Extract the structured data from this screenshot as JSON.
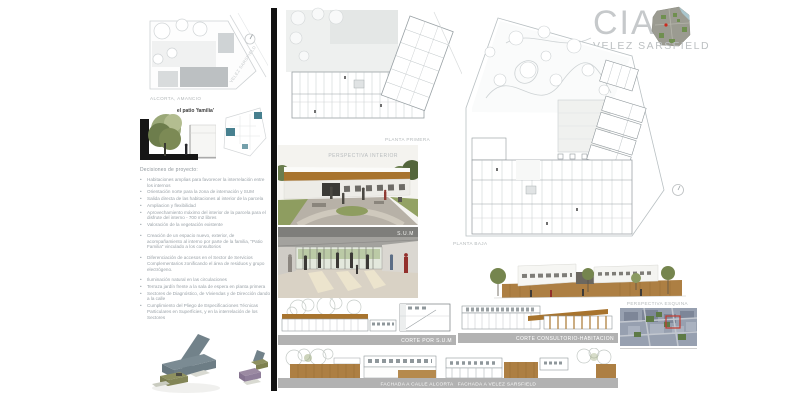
{
  "header": {
    "title": "CIA",
    "subtitle": "VELEZ SARSFIELD"
  },
  "site_plan": {
    "street_bottom": "ALCORTA, AMANCIO",
    "street_side": "VELEZ SARSFIELD"
  },
  "patio_section": {
    "caption": "el patio 'familia'"
  },
  "decisions": {
    "heading": "Decisiones de proyecto:",
    "group1": [
      "Habitaciones amplias para favorecer la interrelación entre los internos",
      "Orientación norte para la zona de internación y SUM",
      "Salida directa de las habitaciones al interior de la parcela",
      "Ampliacion y flexibilidad",
      "Aprovechamiento máximo del interior de la parcela para el disfrute del interno - 700 m2 libres",
      "Valoración de la vegetación existente"
    ],
    "group2": [
      "Creación de un espacio nuevo, exterior, de acompañamiento al interno por parte de la familia, \"Patio Familia\" vinculado a los consultorios"
    ],
    "group3": [
      "Diferenciación de accesos en el Sector de Servicios Complementarios zonificando el área de residuos y grupo electrógeno."
    ],
    "group4": [
      "Iluminación natural en las circulaciones",
      "Terraza jardín frente a la sala de espera en planta primera",
      "Sectores de Diagnóstico, de Viviendas y de Dirección dando a la calle",
      "Cumplimiento del Pliego de Especificaciones Técnicas Particulares en Superficies, y en la interrelación de los Sectores"
    ]
  },
  "drawings": {
    "planta_primera": "PLANTA PRIMERA",
    "planta_baja": "PLANTA BAJA",
    "perspectiva_interior": "PERSPECTIVA INTERIOR",
    "sum": "S.U.M",
    "corte_sum": "CORTE POR S.U.M",
    "corte_consultorio": "CORTE CONSULTORIO-HABITACION",
    "perspectiva_esquina": "PERSPECTIVA ESQUINA",
    "fachada_alcorta": "FACHADA A CALLE ALCORTA",
    "fachada_velez": "FACHADA A VELEZ SARSFIELD"
  },
  "colors": {
    "accent_brown_dark": "#a8742e",
    "accent_brown_light": "#ad7f43",
    "bar_gray": "#b2b2b2",
    "title_gray": "#c6c9cb",
    "text_gray": "#9aa2a8",
    "teal_highlight": "#47808f",
    "divider_black": "#111111"
  }
}
